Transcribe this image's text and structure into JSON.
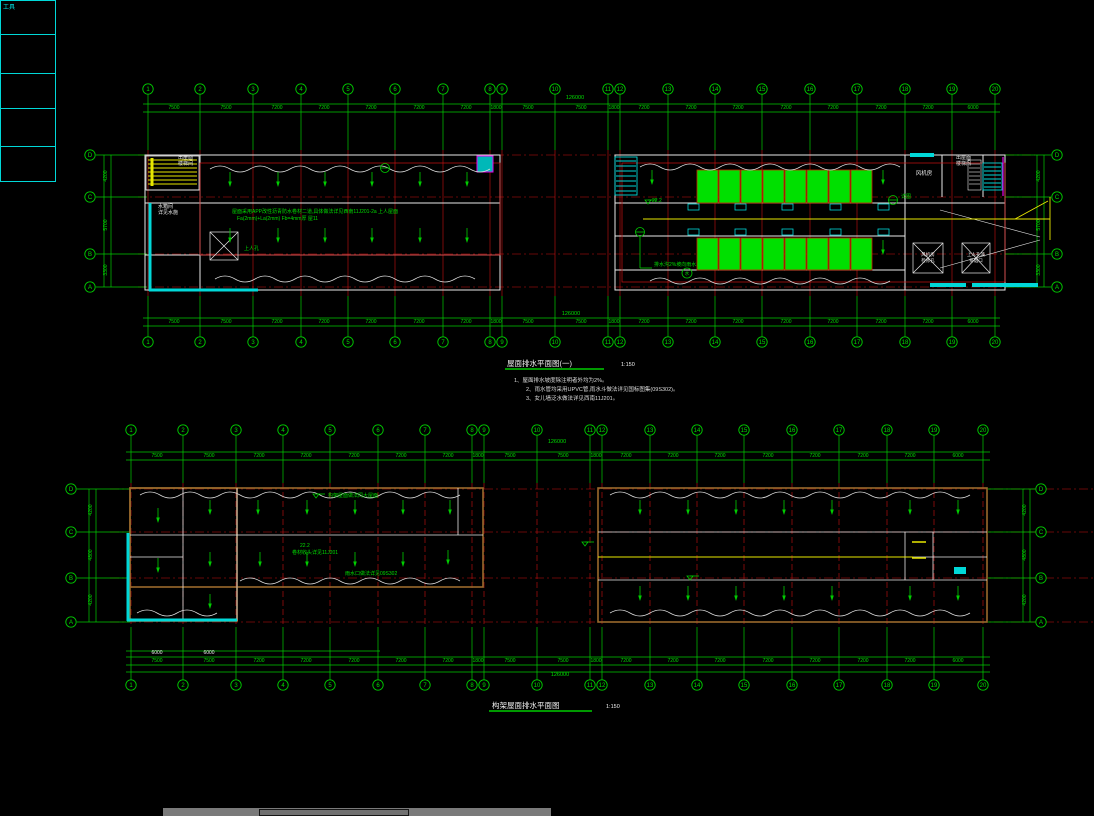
{
  "app": {
    "background": "#000000"
  },
  "palette": {
    "label": "工具"
  },
  "colors": {
    "grid_green": "#00cc00",
    "text_green": "#00dd00",
    "axis_red": "#cc1111",
    "wall_white": "#e8e8e8",
    "wall_brown": "#9a6a2c",
    "cyan": "#00d8d8",
    "yellow": "#e8e800",
    "magenta": "#e800e8",
    "panel_green": "#00e000"
  },
  "plan1": {
    "title": "屋面排水平面图(一)",
    "scale": "1:150",
    "notes": [
      "1、屋面排水坡度除注明者外均为2%。",
      "2、雨水管均采用UPVC管,雨水斗做法详见国标图集(09S302)。",
      "3、女儿墙泛水做法详见西南11J201。"
    ],
    "overall_dim": "126000",
    "axes": [
      {
        "x": 148,
        "label": "1"
      },
      {
        "x": 200,
        "label": "2"
      },
      {
        "x": 253,
        "label": "3"
      },
      {
        "x": 301,
        "label": "4"
      },
      {
        "x": 348,
        "label": "5"
      },
      {
        "x": 395,
        "label": "6"
      },
      {
        "x": 443,
        "label": "7"
      },
      {
        "x": 490,
        "label": "8"
      },
      {
        "x": 502,
        "label": "9"
      },
      {
        "x": 555,
        "label": "10"
      },
      {
        "x": 608,
        "label": "11"
      },
      {
        "x": 620,
        "label": "12"
      },
      {
        "x": 668,
        "label": "13"
      },
      {
        "x": 715,
        "label": "14"
      },
      {
        "x": 762,
        "label": "15"
      },
      {
        "x": 810,
        "label": "16"
      },
      {
        "x": 857,
        "label": "17"
      },
      {
        "x": 905,
        "label": "18"
      },
      {
        "x": 952,
        "label": "19"
      },
      {
        "x": 995,
        "label": "20"
      }
    ],
    "dims": [
      {
        "x": 174,
        "v": "7500"
      },
      {
        "x": 226,
        "v": "7500"
      },
      {
        "x": 277,
        "v": "7200"
      },
      {
        "x": 324,
        "v": "7200"
      },
      {
        "x": 371,
        "v": "7200"
      },
      {
        "x": 419,
        "v": "7200"
      },
      {
        "x": 466,
        "v": "7200"
      },
      {
        "x": 496,
        "v": "1800"
      },
      {
        "x": 528,
        "v": "7500"
      },
      {
        "x": 581,
        "v": "7500"
      },
      {
        "x": 614,
        "v": "1800"
      },
      {
        "x": 644,
        "v": "7200"
      },
      {
        "x": 691,
        "v": "7200"
      },
      {
        "x": 738,
        "v": "7200"
      },
      {
        "x": 786,
        "v": "7200"
      },
      {
        "x": 833,
        "v": "7200"
      },
      {
        "x": 881,
        "v": "7200"
      },
      {
        "x": 928,
        "v": "7200"
      },
      {
        "x": 973,
        "v": "6000"
      }
    ],
    "side_left": [
      {
        "y": 155,
        "label": "D"
      },
      {
        "y": 197,
        "label": "C"
      },
      {
        "y": 254,
        "label": "B"
      },
      {
        "y": 287,
        "label": "A"
      }
    ],
    "side_right": [
      {
        "y": 155,
        "label": "D"
      },
      {
        "y": 197,
        "label": "C"
      },
      {
        "y": 254,
        "label": "B"
      },
      {
        "y": 287,
        "label": "A"
      }
    ],
    "side_dims": [
      {
        "y": 176,
        "v": "4200"
      },
      {
        "y": 225,
        "v": "5700"
      },
      {
        "y": 270,
        "v": "3300"
      }
    ],
    "panel_row1": [
      {
        "x": 697
      },
      {
        "x": 719
      },
      {
        "x": 741
      },
      {
        "x": 763
      },
      {
        "x": 785
      },
      {
        "x": 807
      },
      {
        "x": 829
      },
      {
        "x": 851
      }
    ],
    "panel_row2": [
      {
        "x": 697
      },
      {
        "x": 719
      },
      {
        "x": 741
      },
      {
        "x": 763
      },
      {
        "x": 785
      },
      {
        "x": 807
      },
      {
        "x": 829
      },
      {
        "x": 851
      }
    ],
    "drain_row1": [
      {
        "x": 688
      },
      {
        "x": 735
      },
      {
        "x": 782
      },
      {
        "x": 830
      },
      {
        "x": 878
      }
    ],
    "drain_row2": [
      {
        "x": 688
      },
      {
        "x": 735
      },
      {
        "x": 782
      },
      {
        "x": 830
      },
      {
        "x": 878
      }
    ],
    "labels": {
      "stair_tl1": "出屋面",
      "stair_tl2": "楼梯间",
      "tank1": "水箱间",
      "tank2": "详见水施",
      "spec1": "屋面采用APP改性沥青防水卷材二道,具体做法详见西南11J201-2a  上人屋面",
      "spec2": "Fa(2mm)+La(2mm)  Fb=4mm厚  屋11",
      "hatch_lbl": "上人孔",
      "gutter": "排水沟2%坡向雨水斗",
      "gutter_tag": "水",
      "fan_room": "风机房",
      "xbox1a": "风机房",
      "xbox1b": "检修孔",
      "xbox2a": "上人孔兼",
      "xbox2b": "排烟口",
      "stair_tr1": "出屋面",
      "stair_tr2": "楼梯间",
      "detail_tag": "详图",
      "elev": "22.2"
    }
  },
  "plan2": {
    "title": "构架屋面排水平面图",
    "scale": "1:150",
    "overall_dim": "126000",
    "axes": [
      {
        "x": 131,
        "label": "1"
      },
      {
        "x": 183,
        "label": "2"
      },
      {
        "x": 236,
        "label": "3"
      },
      {
        "x": 283,
        "label": "4"
      },
      {
        "x": 330,
        "label": "5"
      },
      {
        "x": 378,
        "label": "6"
      },
      {
        "x": 425,
        "label": "7"
      },
      {
        "x": 472,
        "label": "8"
      },
      {
        "x": 484,
        "label": "9"
      },
      {
        "x": 537,
        "label": "10"
      },
      {
        "x": 590,
        "label": "11"
      },
      {
        "x": 602,
        "label": "12"
      },
      {
        "x": 650,
        "label": "13"
      },
      {
        "x": 697,
        "label": "14"
      },
      {
        "x": 744,
        "label": "15"
      },
      {
        "x": 792,
        "label": "16"
      },
      {
        "x": 839,
        "label": "17"
      },
      {
        "x": 887,
        "label": "18"
      },
      {
        "x": 934,
        "label": "19"
      },
      {
        "x": 983,
        "label": "20"
      }
    ],
    "dims": [
      {
        "x": 157,
        "v": "7500"
      },
      {
        "x": 209,
        "v": "7500"
      },
      {
        "x": 259,
        "v": "7200"
      },
      {
        "x": 306,
        "v": "7200"
      },
      {
        "x": 354,
        "v": "7200"
      },
      {
        "x": 401,
        "v": "7200"
      },
      {
        "x": 448,
        "v": "7200"
      },
      {
        "x": 478,
        "v": "1800"
      },
      {
        "x": 510,
        "v": "7500"
      },
      {
        "x": 563,
        "v": "7500"
      },
      {
        "x": 596,
        "v": "1800"
      },
      {
        "x": 626,
        "v": "7200"
      },
      {
        "x": 673,
        "v": "7200"
      },
      {
        "x": 720,
        "v": "7200"
      },
      {
        "x": 768,
        "v": "7200"
      },
      {
        "x": 815,
        "v": "7200"
      },
      {
        "x": 863,
        "v": "7200"
      },
      {
        "x": 910,
        "v": "7200"
      },
      {
        "x": 958,
        "v": "6000"
      }
    ],
    "side_left": [
      {
        "y": 489,
        "label": "D"
      },
      {
        "y": 532,
        "label": "C"
      },
      {
        "y": 578,
        "label": "B"
      },
      {
        "y": 622,
        "label": "A"
      }
    ],
    "side_right": [
      {
        "y": 489,
        "label": "D"
      },
      {
        "y": 532,
        "label": "C"
      },
      {
        "y": 578,
        "label": "B"
      },
      {
        "y": 622,
        "label": "A"
      }
    ],
    "side_dims": [
      {
        "y": 510,
        "v": "4200"
      },
      {
        "y": 555,
        "v": "4800"
      },
      {
        "y": 600,
        "v": "4200"
      }
    ],
    "labels": {
      "note_top": "构架屋面做法同大屋面",
      "elev2": "22.2",
      "seam": "卷材收头详见11J201",
      "gutter2": "雨水口做法详见09S302",
      "wdim1": "6000",
      "wdim2": "6000"
    }
  }
}
